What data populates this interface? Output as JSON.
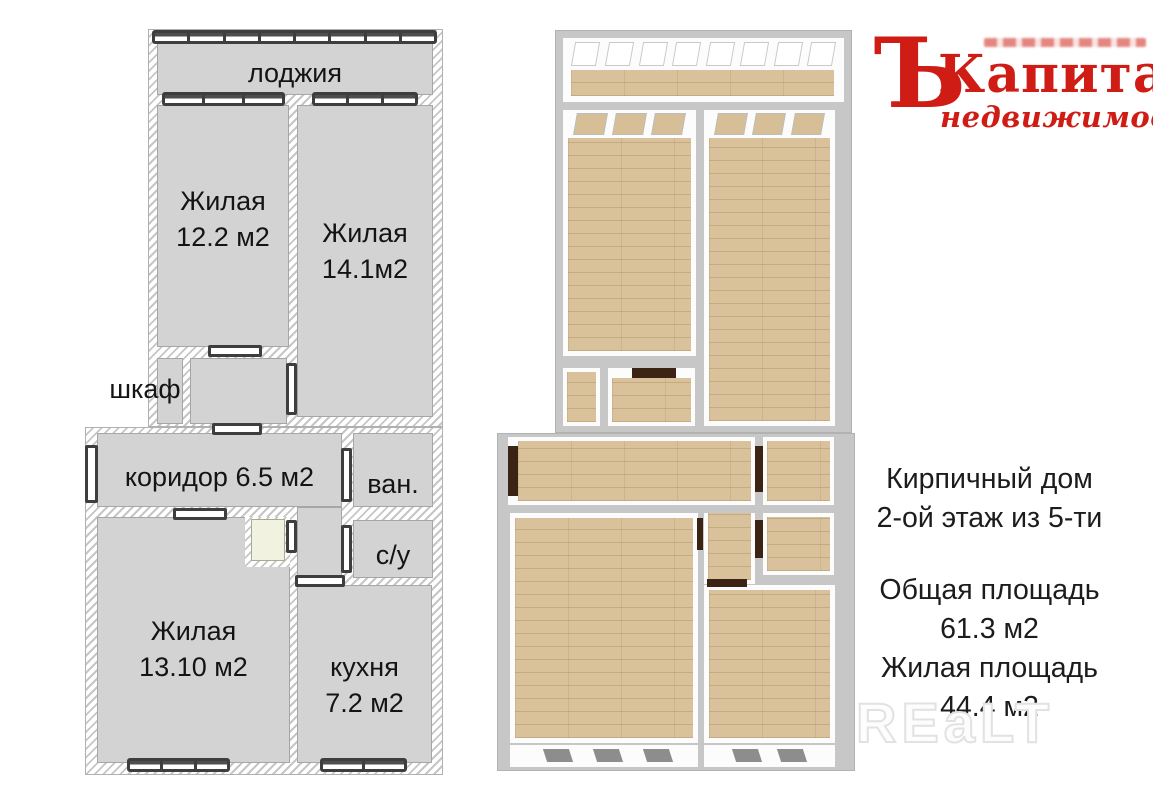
{
  "plan2d": {
    "rooms": {
      "loggia": "лоджия",
      "bedroom1_name": "Жилая",
      "bedroom1_area": "12.2 м2",
      "bedroom2_name": "Жилая",
      "bedroom2_area": "14.1м2",
      "closet": "шкаф",
      "corridor": "коридор 6.5 м2",
      "bathroom": "ван.",
      "wc": "с/у",
      "bedroom3_name": "Жилая",
      "bedroom3_area": "13.10 м2",
      "kitchen_name": "кухня",
      "kitchen_area": "7.2 м2"
    },
    "windows": {
      "loggia_segments": 8,
      "bedroom1_segments": 3,
      "bedroom2_segments": 3,
      "living_segments": 3,
      "kitchen_segments": 2
    },
    "colors": {
      "room_fill": "#d3d3d3",
      "wall_hatch_line": "#c6c6c6",
      "symbol_stroke": "#3e3e3e",
      "pantry_fill": "#f2f2e0"
    }
  },
  "plan3d": {
    "colors": {
      "floor_wood": "#d9c29b",
      "walls": "#fcfcfc",
      "base": "#c7c7c7",
      "door_dark": "#3b2414",
      "window_mark": "#8d8d8d",
      "pantry": "#eef0dc"
    }
  },
  "logo": {
    "mark": "Ъ",
    "title": "Капитал",
    "subtitle": "недвижимости",
    "color": "#cf1d15"
  },
  "info": {
    "lines": [
      "Кирпичный дом",
      "2-ой этаж из 5-ти",
      "Общая площадь",
      "61.3 м2",
      "Жилая площадь",
      "44.4 м2"
    ]
  },
  "watermark": "REaLT"
}
